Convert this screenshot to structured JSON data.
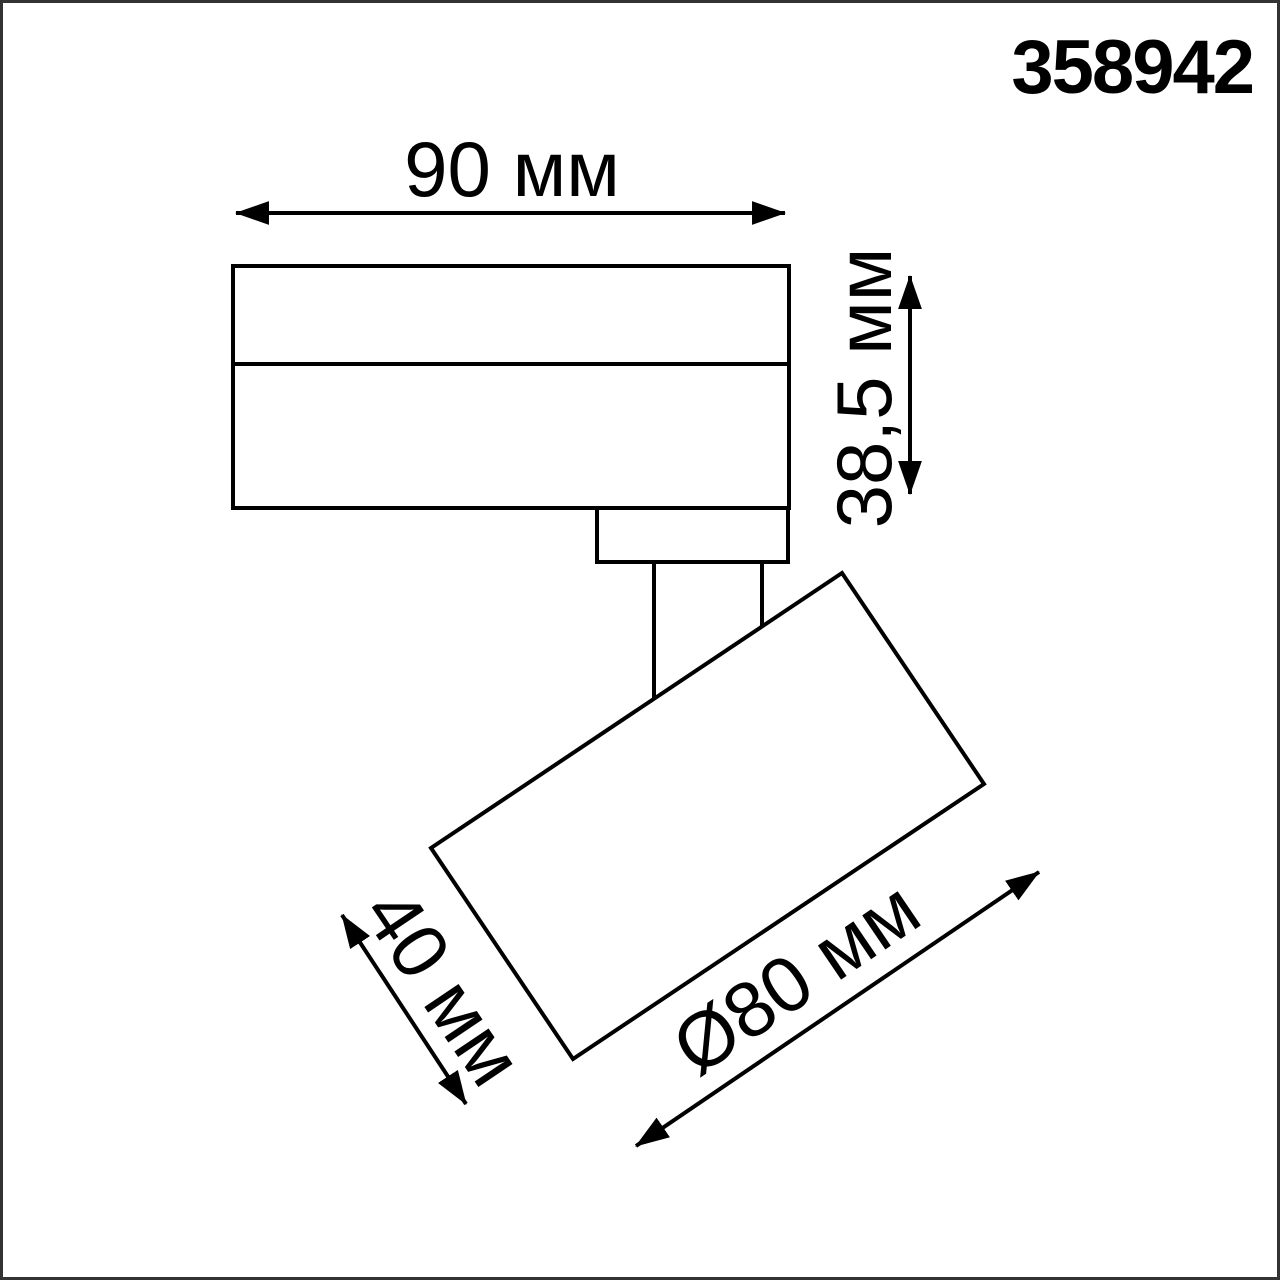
{
  "product": {
    "code": "358942"
  },
  "labels": {
    "body_width": "90 мм",
    "body_height": "38,5 мм",
    "head_depth": "40 мм",
    "head_diameter": "Ø80 мм"
  },
  "units": "мм",
  "colors": {
    "line": "#000000",
    "frame": "#333333",
    "background": "#ffffff",
    "text": "#000000"
  }
}
